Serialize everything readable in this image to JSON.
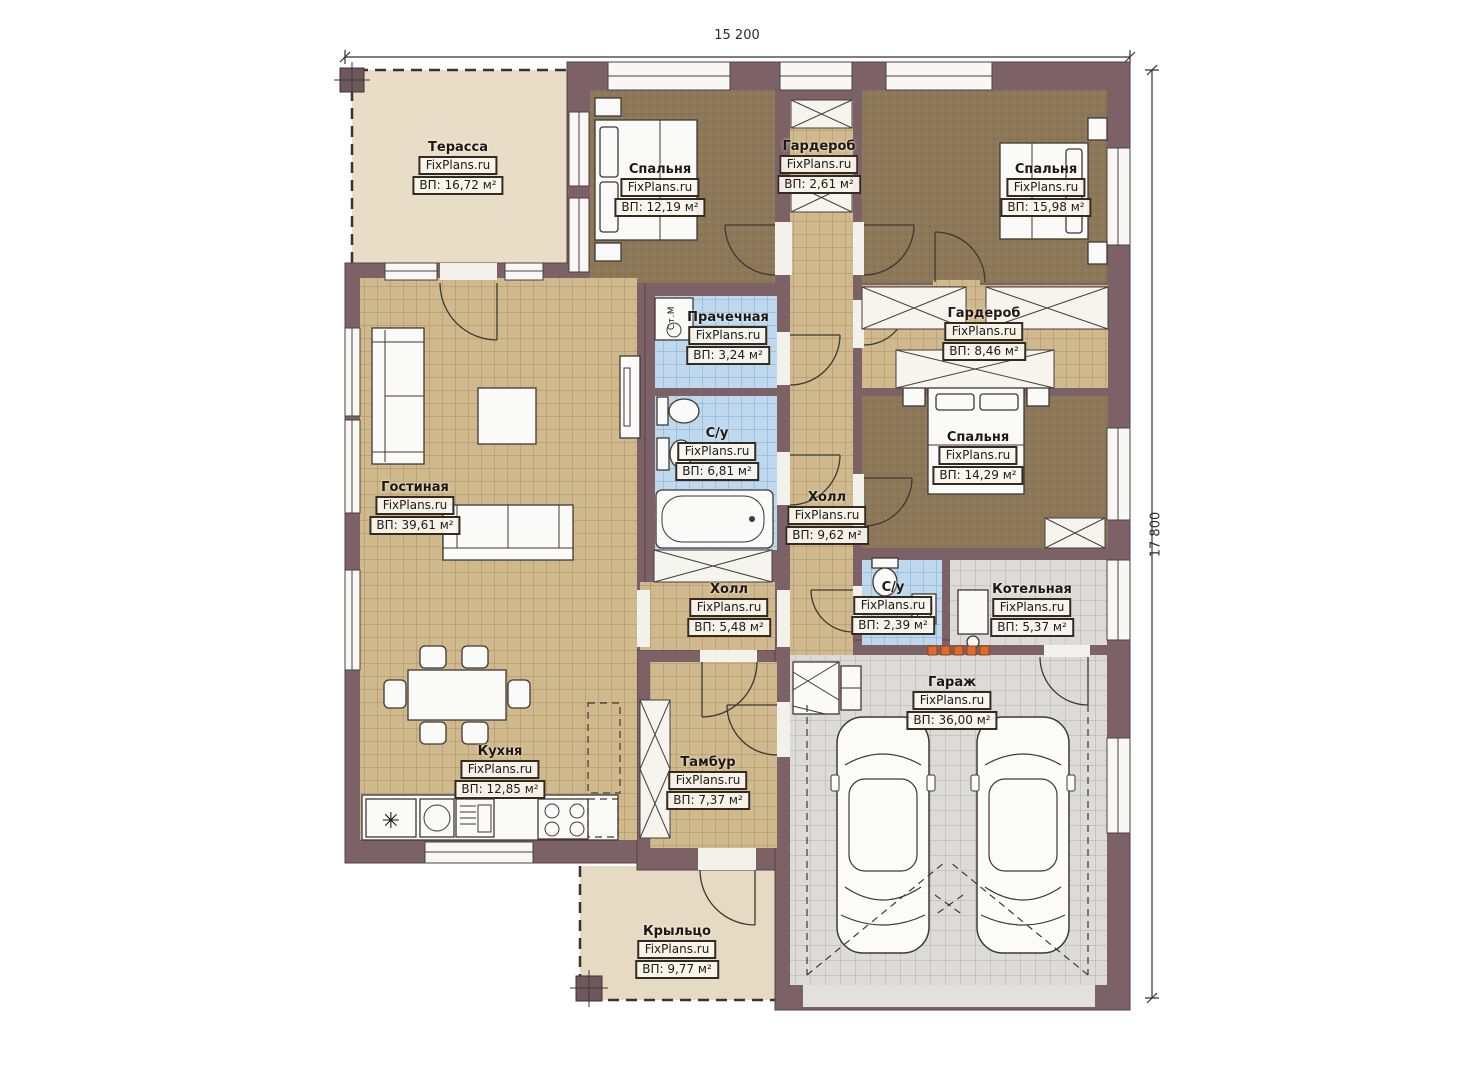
{
  "plan": {
    "brand": "FixPlans.ru",
    "fridge_symbol": "✳",
    "washer_label": "Ст.М",
    "dimensions": {
      "width": "15 200",
      "height": "17 800"
    },
    "rooms": [
      {
        "id": "terrace",
        "name": "Терасса",
        "area": "ВП: 16,72 м²"
      },
      {
        "id": "bedroom1",
        "name": "Спальня",
        "area": "ВП: 12,19 м²"
      },
      {
        "id": "wardrobe1",
        "name": "Гардероб",
        "area": "ВП: 2,61 м²"
      },
      {
        "id": "bedroom2",
        "name": "Спальня",
        "area": "ВП: 15,98 м²"
      },
      {
        "id": "laundry",
        "name": "Прачечная",
        "area": "ВП: 3,24 м²"
      },
      {
        "id": "wardrobe2",
        "name": "Гардероб",
        "area": "ВП: 8,46 м²"
      },
      {
        "id": "bath1",
        "name": "С/у",
        "area": "ВП: 6,81 м²"
      },
      {
        "id": "hall1",
        "name": "Холл",
        "area": "ВП: 9,62 м²"
      },
      {
        "id": "bedroom3",
        "name": "Спальня",
        "area": "ВП: 14,29 м²"
      },
      {
        "id": "living",
        "name": "Гостиная",
        "area": "ВП: 39,61 м²"
      },
      {
        "id": "hall2",
        "name": "Холл",
        "area": "ВП: 5,48 м²"
      },
      {
        "id": "bath2",
        "name": "С/у",
        "area": "ВП: 2,39 м²"
      },
      {
        "id": "boiler",
        "name": "Котельная",
        "area": "ВП: 5,37 м²"
      },
      {
        "id": "kitchen",
        "name": "Кухня",
        "area": "ВП: 12,85 м²"
      },
      {
        "id": "vestibule",
        "name": "Тамбур",
        "area": "ВП: 7,37 м²"
      },
      {
        "id": "garage",
        "name": "Гараж",
        "area": "ВП: 36,00 м²"
      },
      {
        "id": "porch",
        "name": "Крыльцо",
        "area": "ВП: 9,77 м²"
      }
    ]
  }
}
